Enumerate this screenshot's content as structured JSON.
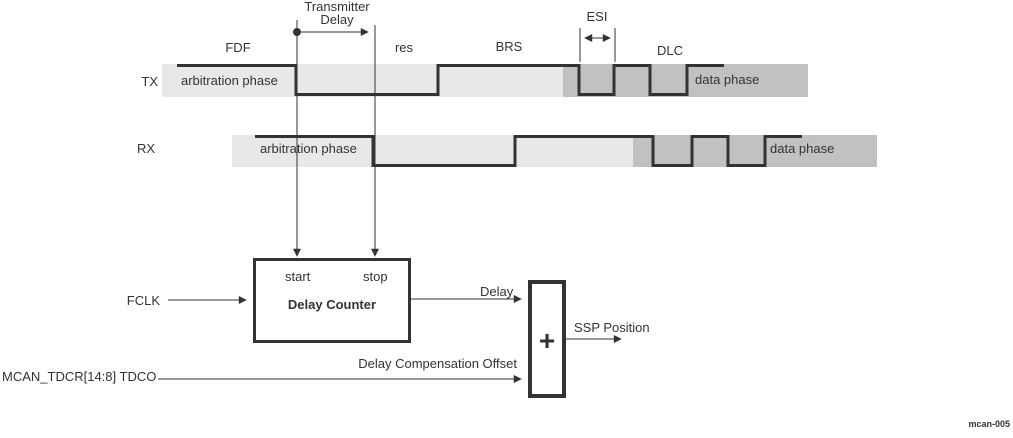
{
  "colors": {
    "band_light": "#e8e8e8",
    "band_dark": "#c1c1c1",
    "line": "#333333",
    "text": "#333333"
  },
  "annotations": {
    "transmitter_delay_line1": "Transmitter",
    "transmitter_delay_line2": "Delay",
    "fdf": "FDF",
    "res": "res",
    "brs": "BRS",
    "esi": "ESI",
    "dlc": "DLC",
    "figure_id": "mcan-005"
  },
  "tx": {
    "label": "TX",
    "arbitration_phase": "arbitration phase",
    "data_phase": "data phase"
  },
  "rx": {
    "label": "RX",
    "arbitration_phase": "arbitration phase",
    "data_phase": "data phase"
  },
  "delay_counter": {
    "title": "Delay Counter",
    "start": "start",
    "stop": "stop"
  },
  "adder": {
    "symbol": "+"
  },
  "signals": {
    "fclk": "FCLK",
    "delay": "Delay",
    "delay_compensation_offset": "Delay Compensation Offset",
    "tdco_register": "MCAN_TDCR[14:8] TDCO",
    "ssp_position": "SSP Position"
  }
}
